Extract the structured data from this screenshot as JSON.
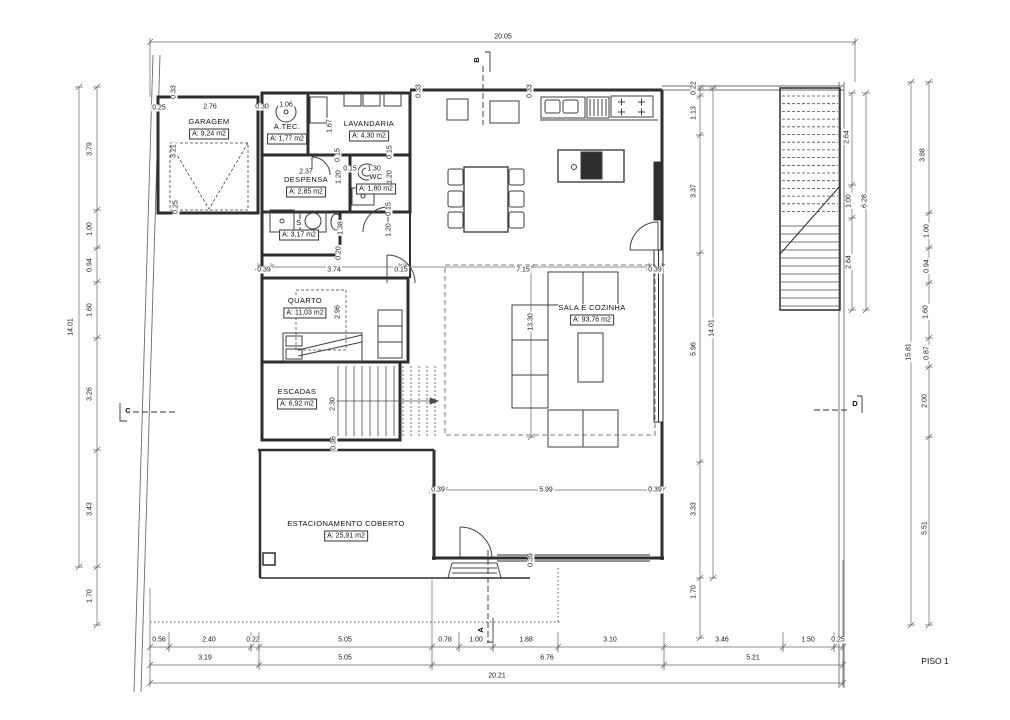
{
  "sheet": {
    "label": "PISO 1"
  },
  "rooms": [
    {
      "id": "garagem",
      "name": "GARAGEM",
      "area": "A: 9,24 m2",
      "x": 209,
      "y": 122
    },
    {
      "id": "atec",
      "name": "A.TEC.",
      "area": "A: 1,77 m2",
      "x": 287,
      "y": 127
    },
    {
      "id": "lavandaria",
      "name": "LAVANDARIA",
      "area": "A: 4,30 m2",
      "x": 369,
      "y": 124
    },
    {
      "id": "despensa",
      "name": "DESPENSA",
      "area": "A: 2,85 m2",
      "x": 306,
      "y": 180
    },
    {
      "id": "wc",
      "name": "WC",
      "area": "A: 1,80 m2",
      "x": 376,
      "y": 177
    },
    {
      "id": "is",
      "name": "S",
      "area": "A: 3,17 m2",
      "x": 299,
      "y": 223
    },
    {
      "id": "quarto",
      "name": "QUARTO",
      "area": "A: 11,03 m2",
      "x": 305,
      "y": 301
    },
    {
      "id": "escadas",
      "name": "ESCADAS",
      "area": "A: 6,92 m2",
      "x": 297,
      "y": 392
    },
    {
      "id": "sala",
      "name": "SALA E COZINHA",
      "area": "A: 93,76 m2",
      "x": 592,
      "y": 308
    },
    {
      "id": "estacionamento",
      "name": "ESTACIONAMENTO COBERTO",
      "area": "A: 25,91 m2",
      "x": 346,
      "y": 524
    }
  ],
  "section_markers": [
    {
      "letter": "A",
      "x": 481,
      "y": 630,
      "r": 1
    },
    {
      "letter": "B",
      "x": 477,
      "y": 60,
      "r": 1
    },
    {
      "letter": "C",
      "x": 128,
      "y": 411,
      "r": 0
    },
    {
      "letter": "D",
      "x": 855,
      "y": 404,
      "r": 0
    }
  ],
  "dimension_labels": [
    {
      "t": "20.05",
      "x": 503,
      "y": 37,
      "r": 0
    },
    {
      "t": "14.01",
      "x": 71,
      "y": 327,
      "r": 1
    },
    {
      "t": "3.79",
      "x": 90,
      "y": 149,
      "r": 1
    },
    {
      "t": "1.00",
      "x": 90,
      "y": 229,
      "r": 1
    },
    {
      "t": "0.94",
      "x": 90,
      "y": 265,
      "r": 1
    },
    {
      "t": "1.60",
      "x": 90,
      "y": 310,
      "r": 1
    },
    {
      "t": "3.26",
      "x": 90,
      "y": 394,
      "r": 1
    },
    {
      "t": "3.43",
      "x": 90,
      "y": 509,
      "r": 1
    },
    {
      "t": "1.70",
      "x": 90,
      "y": 596,
      "r": 1
    },
    {
      "t": "0.22",
      "x": 694,
      "y": 88,
      "r": 1
    },
    {
      "t": "1.13",
      "x": 694,
      "y": 113,
      "r": 1
    },
    {
      "t": "3.37",
      "x": 694,
      "y": 191,
      "r": 1
    },
    {
      "t": "5.96",
      "x": 694,
      "y": 349,
      "r": 1
    },
    {
      "t": "3.33",
      "x": 694,
      "y": 509,
      "r": 1
    },
    {
      "t": "1.70",
      "x": 694,
      "y": 592,
      "r": 1
    },
    {
      "t": "14.01",
      "x": 712,
      "y": 328,
      "r": 1
    },
    {
      "t": "2.64",
      "x": 847,
      "y": 137,
      "r": 1
    },
    {
      "t": "1.00",
      "x": 849,
      "y": 201,
      "r": 1
    },
    {
      "t": "2.64",
      "x": 849,
      "y": 262,
      "r": 1
    },
    {
      "t": "6.28",
      "x": 865,
      "y": 201,
      "r": 1
    },
    {
      "t": "3.88",
      "x": 923,
      "y": 155,
      "r": 1
    },
    {
      "t": "1.00",
      "x": 927,
      "y": 231,
      "r": 1
    },
    {
      "t": "0.94",
      "x": 927,
      "y": 266,
      "r": 1
    },
    {
      "t": "1.60",
      "x": 926,
      "y": 312,
      "r": 1
    },
    {
      "t": "0.87",
      "x": 927,
      "y": 353,
      "r": 1
    },
    {
      "t": "2.00",
      "x": 925,
      "y": 401,
      "r": 1
    },
    {
      "t": "5.51",
      "x": 925,
      "y": 528,
      "r": 1
    },
    {
      "t": "15.81",
      "x": 909,
      "y": 352,
      "r": 1
    },
    {
      "t": "0.56",
      "x": 159,
      "y": 640,
      "r": 0
    },
    {
      "t": "2.40",
      "x": 209,
      "y": 640,
      "r": 0
    },
    {
      "t": "0.22",
      "x": 253,
      "y": 640,
      "r": 0
    },
    {
      "t": "5.05",
      "x": 345,
      "y": 640,
      "r": 0
    },
    {
      "t": "0.78",
      "x": 445,
      "y": 640,
      "r": 0
    },
    {
      "t": "1.00",
      "x": 476,
      "y": 640,
      "r": 0
    },
    {
      "t": "1.88",
      "x": 526,
      "y": 640,
      "r": 0
    },
    {
      "t": "3.10",
      "x": 610,
      "y": 640,
      "r": 0
    },
    {
      "t": "3.46",
      "x": 722,
      "y": 640,
      "r": 0
    },
    {
      "t": "1.50",
      "x": 808,
      "y": 640,
      "r": 0
    },
    {
      "t": "0.25",
      "x": 838,
      "y": 640,
      "r": 0
    },
    {
      "t": "3.19",
      "x": 205,
      "y": 658,
      "r": 0
    },
    {
      "t": "5.05",
      "x": 345,
      "y": 658,
      "r": 0
    },
    {
      "t": "6.76",
      "x": 547,
      "y": 658,
      "r": 0
    },
    {
      "t": "5.21",
      "x": 753,
      "y": 658,
      "r": 0
    },
    {
      "t": "20.21",
      "x": 497,
      "y": 676,
      "r": 0
    },
    {
      "t": "0.25",
      "x": 159,
      "y": 108,
      "r": 0
    },
    {
      "t": "2.76",
      "x": 210,
      "y": 107,
      "r": 0
    },
    {
      "t": "0.30",
      "x": 262,
      "y": 107,
      "r": 0
    },
    {
      "t": "1.06",
      "x": 286,
      "y": 105,
      "r": 0
    },
    {
      "t": "0.33",
      "x": 174,
      "y": 92,
      "r": 1
    },
    {
      "t": "3.21",
      "x": 174,
      "y": 151,
      "r": 1
    },
    {
      "t": "0.25",
      "x": 176,
      "y": 207,
      "r": 1
    },
    {
      "t": "1.67",
      "x": 330,
      "y": 126,
      "r": 1
    },
    {
      "t": "0.33",
      "x": 419,
      "y": 91,
      "r": 1
    },
    {
      "t": "0.33",
      "x": 530,
      "y": 91,
      "r": 1
    },
    {
      "t": "2.37",
      "x": 306,
      "y": 172,
      "r": 0
    },
    {
      "t": "0.15",
      "x": 350,
      "y": 169,
      "r": 0
    },
    {
      "t": "1.30",
      "x": 374,
      "y": 169,
      "r": 0
    },
    {
      "t": "0.15",
      "x": 338,
      "y": 155,
      "r": 1
    },
    {
      "t": "1.20",
      "x": 339,
      "y": 177,
      "r": 1
    },
    {
      "t": "0.15",
      "x": 390,
      "y": 152,
      "r": 1
    },
    {
      "t": "1.20",
      "x": 390,
      "y": 177,
      "r": 1
    },
    {
      "t": "0.15",
      "x": 389,
      "y": 209,
      "r": 1
    },
    {
      "t": "1.20",
      "x": 389,
      "y": 230,
      "r": 1
    },
    {
      "t": "1.38",
      "x": 341,
      "y": 228,
      "r": 1
    },
    {
      "t": "0.20",
      "x": 339,
      "y": 253,
      "r": 1
    },
    {
      "t": "0.39",
      "x": 264,
      "y": 270,
      "r": 0
    },
    {
      "t": "3.74",
      "x": 334,
      "y": 270,
      "r": 0
    },
    {
      "t": "0.15",
      "x": 401,
      "y": 270,
      "r": 0
    },
    {
      "t": "7.15",
      "x": 523,
      "y": 270,
      "r": 0
    },
    {
      "t": "0.39",
      "x": 655,
      "y": 270,
      "r": 0
    },
    {
      "t": "2.96",
      "x": 338,
      "y": 312,
      "r": 1
    },
    {
      "t": "13.30",
      "x": 531,
      "y": 322,
      "r": 1
    },
    {
      "t": "2.30",
      "x": 333,
      "y": 404,
      "r": 1
    },
    {
      "t": "0.36",
      "x": 334,
      "y": 443,
      "r": 1
    },
    {
      "t": "0.39",
      "x": 438,
      "y": 490,
      "r": 0
    },
    {
      "t": "5.99",
      "x": 546,
      "y": 490,
      "r": 0
    },
    {
      "t": "0.39",
      "x": 655,
      "y": 490,
      "r": 0
    },
    {
      "t": "0.39",
      "x": 531,
      "y": 560,
      "r": 1
    }
  ]
}
